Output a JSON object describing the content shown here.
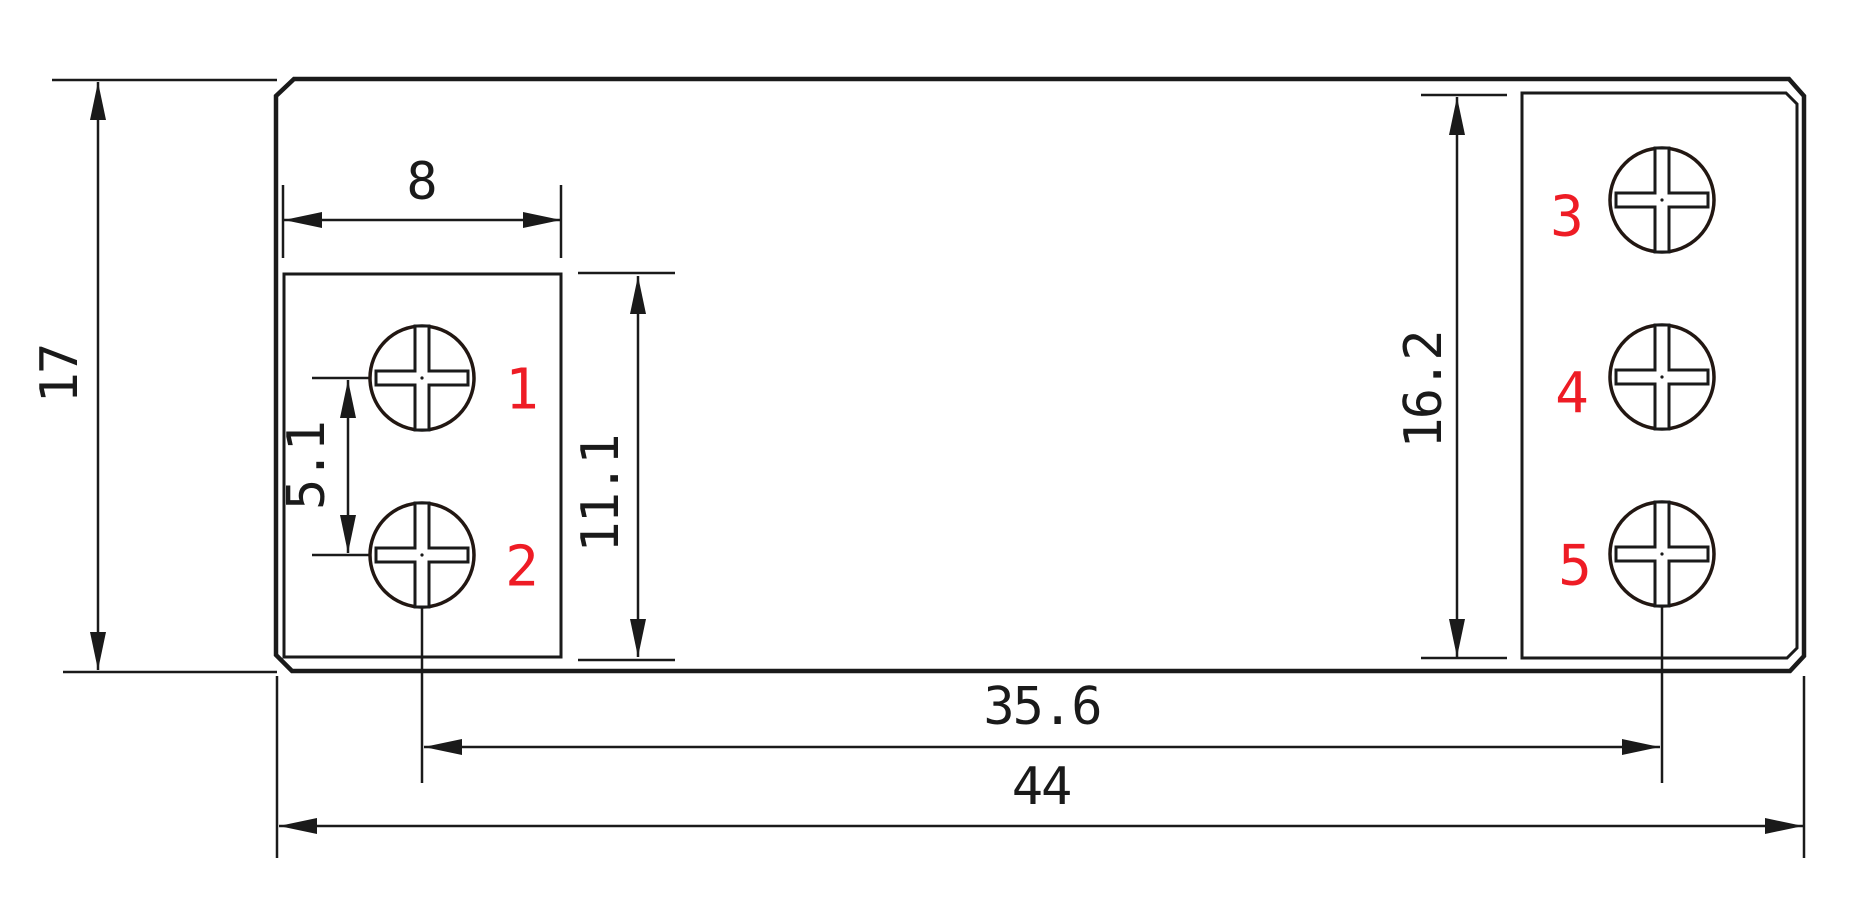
{
  "drawing": {
    "type": "technical-dimension-drawing",
    "subject": "5-terminal screw block footprint",
    "dimensions": {
      "overall_height": "17",
      "terminal_slot_width": "8",
      "screw_pitch": "5.1",
      "left_slot_height": "11.1",
      "right_slot_height": "16.2",
      "screw_span": "35.6",
      "overall_width": "44"
    },
    "terminals": [
      "1",
      "2",
      "3",
      "4",
      "5"
    ],
    "colors": {
      "line": "#1a1a1a",
      "terminal_number": "#ee1c25",
      "background": "#ffffff"
    }
  }
}
